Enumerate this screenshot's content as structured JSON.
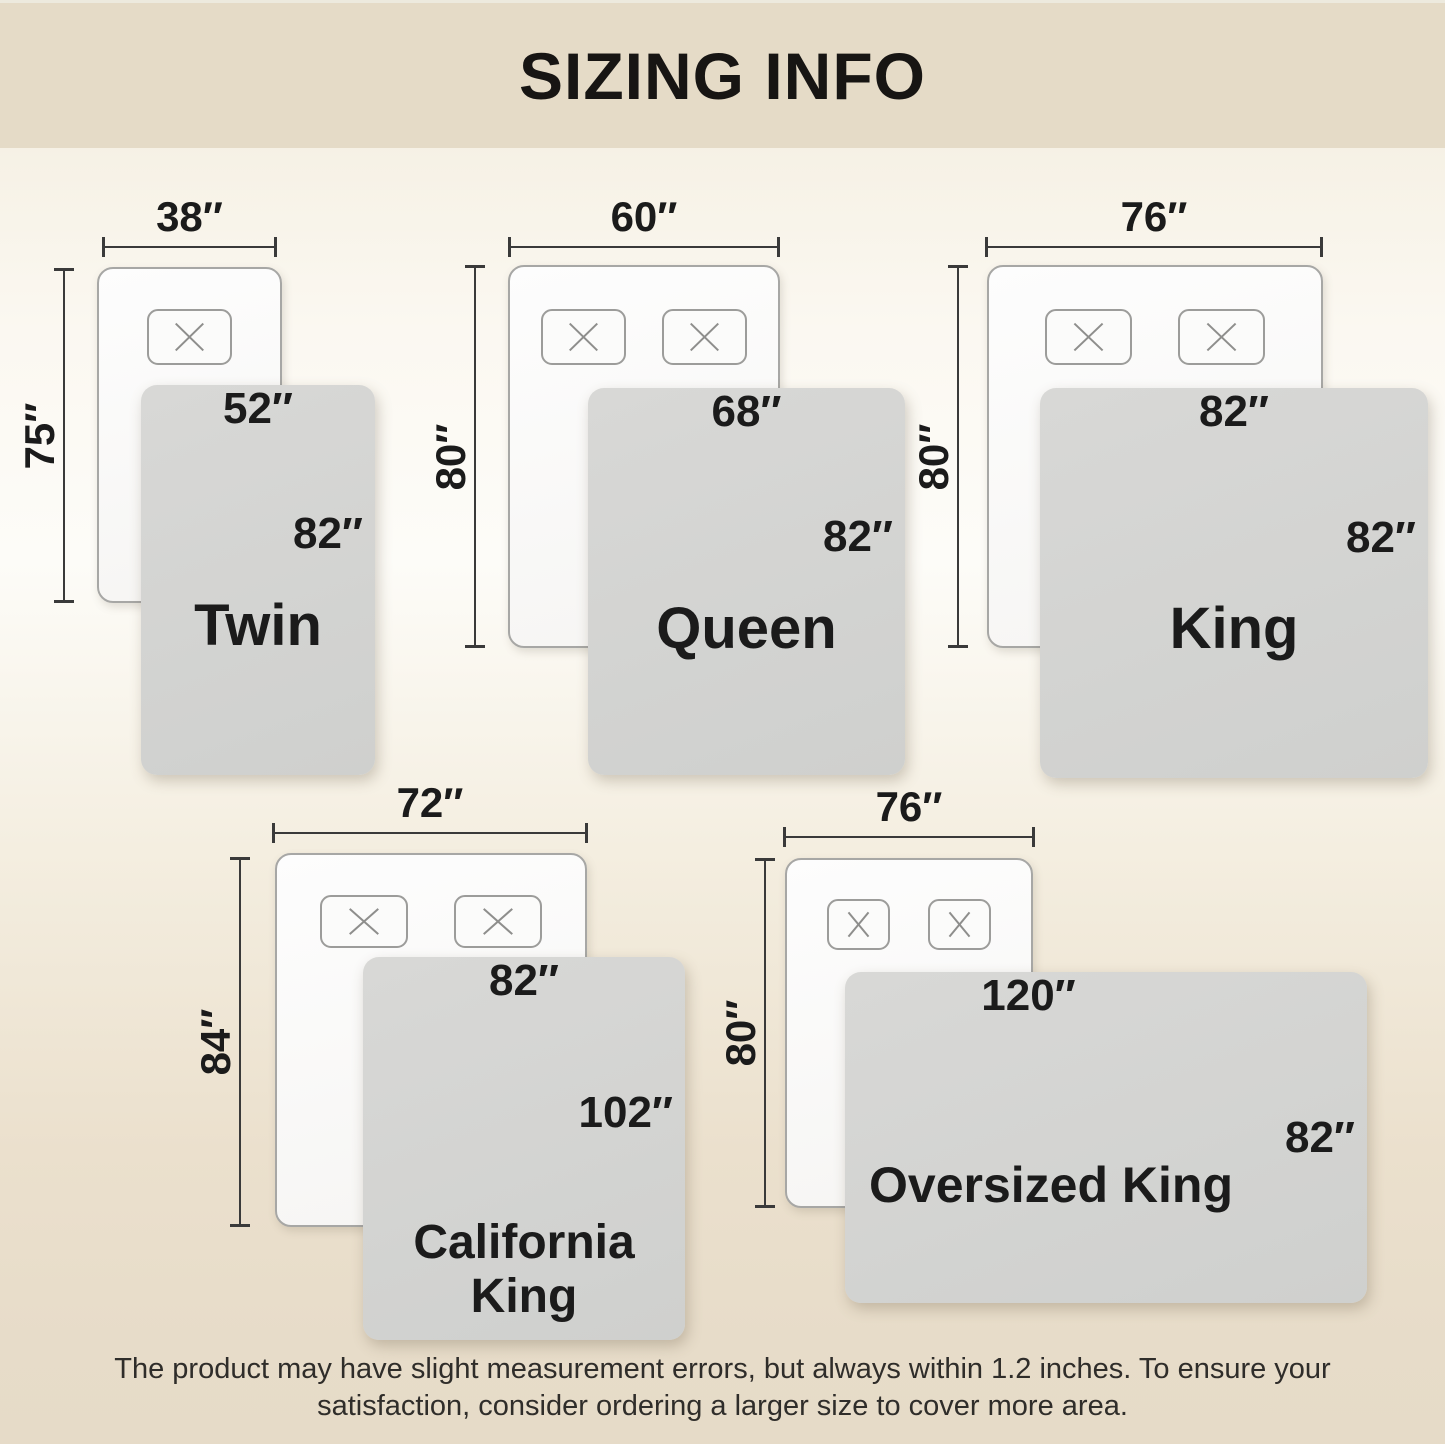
{
  "page": {
    "title": "SIZING INFO",
    "disclaimer_line1": "The product may have slight measurement errors, but always within 1.2 inches. To ensure your",
    "disclaimer_line2": "satisfaction, consider ordering a larger size to cover more area."
  },
  "colors": {
    "banner_bg": "#e5dbc7",
    "background_light": "#fdfcf8",
    "background_dark": "#e6dbc8",
    "blanket_gray": "#d3d3d2",
    "mattress_white": "#fbfbfa",
    "text_dark": "#1b1b1b"
  },
  "icons": {
    "pillow_mark": "x-stitch"
  },
  "sizes": [
    {
      "name": "Twin",
      "mattress_width": "38″",
      "mattress_length": "75″",
      "blanket_width": "52″",
      "blanket_length": "82″",
      "pillow_count": 1
    },
    {
      "name": "Queen",
      "mattress_width": "60″",
      "mattress_length": "80″",
      "blanket_width": "68″",
      "blanket_length": "82″",
      "pillow_count": 2
    },
    {
      "name": "King",
      "mattress_width": "76″",
      "mattress_length": "80″",
      "blanket_width": "82″",
      "blanket_length": "82″",
      "pillow_count": 2
    },
    {
      "name": "California King",
      "mattress_width": "72″",
      "mattress_length": "84″",
      "blanket_width": "82″",
      "blanket_length": "102″",
      "pillow_count": 2
    },
    {
      "name": "Oversized King",
      "mattress_width": "76″",
      "mattress_length": "80″",
      "blanket_width": "120″",
      "blanket_length": "82″",
      "pillow_count": 2
    }
  ]
}
